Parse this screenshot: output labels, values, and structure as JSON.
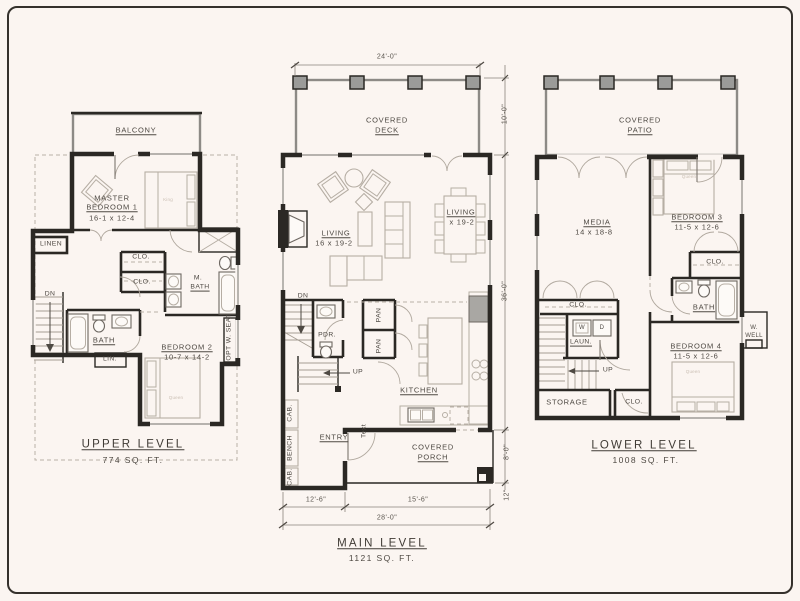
{
  "canvas": {
    "bg": "#fbf5f1",
    "border_color": "#35312c"
  },
  "upper": {
    "title": "UPPER LEVEL",
    "area": "774 SQ. FT.",
    "labels": {
      "balcony": "BALCONY",
      "master_line1": "MASTER",
      "master_line2": "BEDROOM 1",
      "master_dims": "16-1 x 12-4",
      "linen": "LINEN",
      "clo_a": "CLO.",
      "clo_b": "CLO.",
      "mbath_line1": "M.",
      "mbath_line2": "BATH",
      "dn": "DN",
      "bath": "BATH",
      "lin": "LIN.",
      "bed2_line1": "BEDROOM 2",
      "bed2_dims": "10-7 x 14-2",
      "opt_seat": "OPT W. SEAT",
      "king": "King",
      "queen": "Queen"
    }
  },
  "main": {
    "title": "MAIN LEVEL",
    "area": "1121 SQ. FT.",
    "labels": {
      "deck_line1": "COVERED",
      "deck_line2": "DECK",
      "living_line1": "LIVING",
      "living_dims": "16 x 19-2",
      "dining_line1": "LIVING",
      "dining_dims": "x 19-2",
      "dn": "DN",
      "pdr": "PDR.",
      "pan_a": "PAN",
      "pan_b": "PAN",
      "up": "UP",
      "kitchen": "KITCHEN",
      "cab_a": "CAB.",
      "bench": "BENCH",
      "cab_b": "CAB.",
      "entry": "ENTRY",
      "text_note": "Text",
      "porch_line1": "COVERED",
      "porch_line2": "PORCH"
    },
    "dims": {
      "top": "24'-0\"",
      "deck_h": "10'-0\"",
      "body_h": "36'-0\"",
      "porch_h": "8'-0\"",
      "step": "12\"",
      "bottom_left": "12'-6\"",
      "bottom_right": "15'-6\"",
      "bottom_total": "28'-0\""
    }
  },
  "lower": {
    "title": "LOWER LEVEL",
    "area": "1008 SQ. FT.",
    "labels": {
      "patio_line1": "COVERED",
      "patio_line2": "PATIO",
      "media": "MEDIA",
      "media_dims": "14 x 18-8",
      "bed3": "BEDROOM 3",
      "bed3_dims": "11-5 x 12-6",
      "clo_top": "CLO.",
      "bath": "BATH",
      "clo_mid": "CLO.",
      "washer": "W",
      "dryer": "D",
      "laun": "LAUN.",
      "up": "UP",
      "storage": "STORAGE",
      "clo_bottom": "CLO.",
      "bed4": "BEDROOM 4",
      "bed4_dims": "11-5 x 12-6",
      "wwell_line1": "W.",
      "wwell_line2": "WELL",
      "queen3": "Queen",
      "queen4": "Queen"
    }
  }
}
